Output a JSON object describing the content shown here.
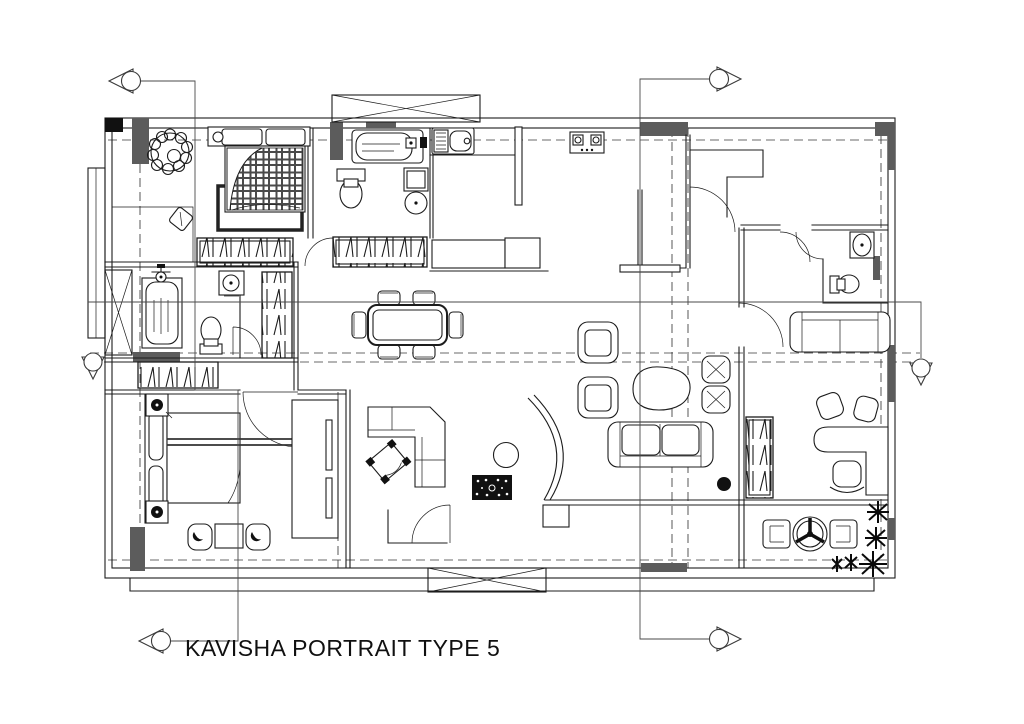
{
  "drawing": {
    "title": "KAVISHA PORTRAIT TYPE 5",
    "kind": "architectural floor plan",
    "colors": {
      "line": "#1c1c1c",
      "wall_fill": "#5c5c5c",
      "dark_fill": "#111111",
      "section_line": "#4a4a4a",
      "background": "#ffffff"
    }
  },
  "markers": {
    "section_markers": [
      "section-marker-top-left",
      "section-marker-bottom-left",
      "section-marker-top-right",
      "section-marker-bottom-right"
    ],
    "level_markers": [
      "level-marker-left",
      "level-marker-right"
    ]
  },
  "fixtures": [
    "double-bed",
    "plaid-duvet",
    "area-rug",
    "spiral-plant",
    "dresser-stool",
    "wardrobe-shelf-unit",
    "bathtub",
    "toilet",
    "washbasin",
    "shower",
    "lift-shaft",
    "kitchen-sink",
    "cooktop",
    "kitchen-peninsula",
    "door-swing",
    "powder-basin",
    "powder-toilet",
    "two-seat-sofa",
    "dining-table-six-chairs",
    "armchair",
    "coffee-table",
    "x-ottoman",
    "three-seat-sofa",
    "tall-wardrobe",
    "l-shaped-desk",
    "office-chair",
    "guest-chair",
    "balcony-chair",
    "round-balcony-table",
    "potted-plants",
    "single-bed",
    "bedside-lamp",
    "corner-sofa",
    "round-side-table",
    "decorative-black-rug",
    "curved-partition",
    "planter-box"
  ]
}
